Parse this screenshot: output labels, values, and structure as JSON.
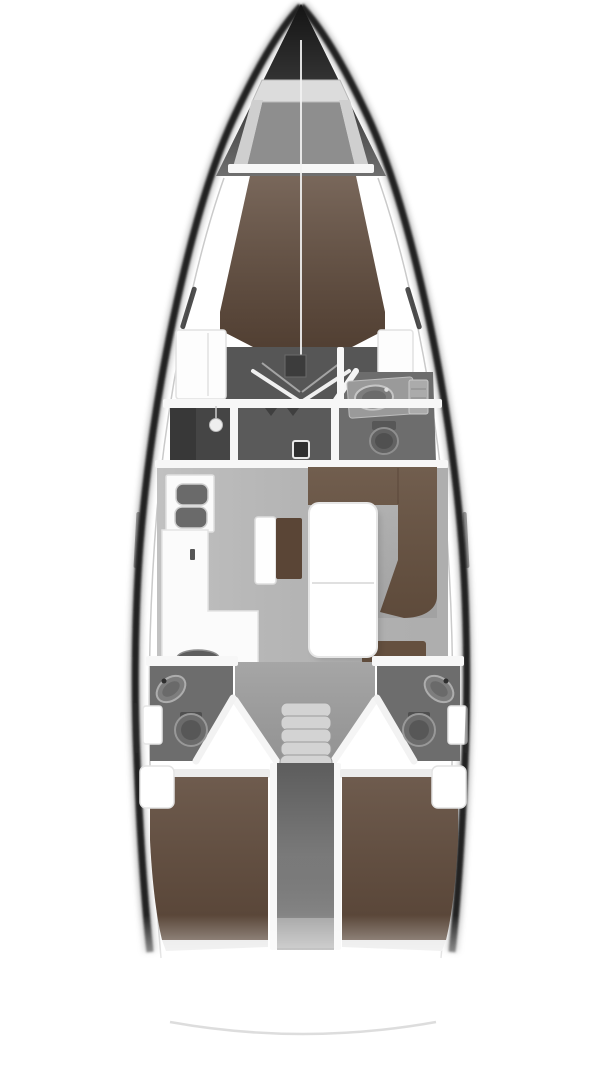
{
  "diagram": {
    "type": "yacht-interior-floor-plan",
    "orientation": "bow-up",
    "rooms": [
      {
        "name": "anchor-locker"
      },
      {
        "name": "forward-cabin-v-berth"
      },
      {
        "name": "forward-head"
      },
      {
        "name": "wardrobe"
      },
      {
        "name": "entry-corridor"
      },
      {
        "name": "galley"
      },
      {
        "name": "salon"
      },
      {
        "name": "navigation-bench"
      },
      {
        "name": "u-shaped-settee"
      },
      {
        "name": "salon-table"
      },
      {
        "name": "companionway-steps"
      },
      {
        "name": "port-aft-head"
      },
      {
        "name": "starboard-aft-head"
      },
      {
        "name": "engine-compartment-corridor"
      },
      {
        "name": "port-aft-cabin-berth"
      },
      {
        "name": "starboard-aft-cabin-berth"
      },
      {
        "name": "stern-transom"
      }
    ]
  },
  "colors": {
    "hull_dark": "#242424",
    "deck_white": "#ffffff",
    "berth_brown": "#5f4a3b",
    "settee_brown": "#65503f",
    "seat_brown": "#5a4536",
    "salon_floor": "#b9b9b9",
    "cabin_floor_dark": "#565656",
    "wardrobe_dark": "#454545",
    "entry_floor": "#5a5a5a",
    "head_floor": "#6d6d6d",
    "landing_gray": "#9e9e9e",
    "corridor_gray": "#808080",
    "step_gray": "#d3d3d3",
    "fixture_gray": "#7d7d7d",
    "counter_white": "#fbfbfb",
    "wall_white": "#f7f7f7",
    "footboard_light": "#e6e6e6",
    "stern_arc": "#d9d9d9",
    "window_slit": "#303030",
    "mast_line": "#f2f2f2"
  }
}
